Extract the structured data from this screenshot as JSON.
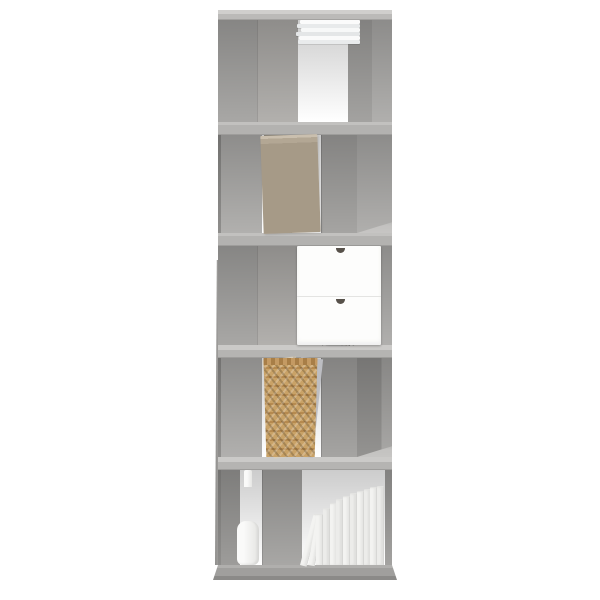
{
  "meta": {
    "kind": "product-photograph",
    "background_color": "#ffffff"
  },
  "product": {
    "name": "5-tier book cabinet room divider, concrete grey",
    "style": "staggered open cubes with alternating vertical dividers, open back",
    "tier_count": 5,
    "frame_color_name": "concrete grey",
    "palette": {
      "frame_light": "#c9c8c6",
      "frame_mid": "#aeadab",
      "frame_dark": "#8f8e8c",
      "background": "#ffffff"
    }
  },
  "decor": {
    "tier1": {
      "item": "stack of white magazines lying flat",
      "layers": 6,
      "color": "#f6f7f7"
    },
    "tier2": {
      "items": [
        "wooden picture frame",
        "wooden block",
        "stack of wooden planks"
      ],
      "colors": [
        "#8f897d",
        "#c59a67",
        "#b3a794"
      ]
    },
    "tier3": {
      "items": [
        "white pen cup with pens, pencils and brushes",
        "white mini drawer unit"
      ],
      "pen_count": 9,
      "drawer_count": 2,
      "colors": [
        "#f4f4f2",
        "#fdfdfc"
      ]
    },
    "tier4": {
      "items": [
        "woven wicker basket",
        "paper folders sticking out"
      ],
      "colors": [
        "#c49a63",
        "#d6cdbd",
        "#bcbdc2"
      ]
    },
    "tier5": {
      "items": [
        "white bottle vase",
        "row of white books"
      ],
      "book_count": 12,
      "colors": [
        "#f3f3f1",
        "#f0f0ee"
      ]
    }
  },
  "render": {
    "magazine_layers": [
      {
        "c": "#fbfbfb",
        "off": 4
      },
      {
        "c": "#e8eaeb",
        "off": 1
      },
      {
        "c": "#f7f8f8",
        "off": 5
      },
      {
        "c": "#e4e6e7",
        "off": 0
      },
      {
        "c": "#fafafa",
        "off": 3
      },
      {
        "c": "#e9ebec",
        "off": 2
      }
    ],
    "pens": [
      {
        "x": 4,
        "h": 26,
        "a": -30,
        "c": "#2f2f2f"
      },
      {
        "x": 8,
        "h": 30,
        "a": -14,
        "c": "#777777"
      },
      {
        "x": 12,
        "h": 24,
        "a": -6,
        "c": "#8a6a4a"
      },
      {
        "x": 15,
        "h": 31,
        "a": 0,
        "c": "#3c3c3c"
      },
      {
        "x": 19,
        "h": 27,
        "a": 4,
        "c": "#9b9b9b"
      },
      {
        "x": 22,
        "h": 30,
        "a": 10,
        "c": "#2f2f2f"
      },
      {
        "x": 26,
        "h": 24,
        "a": 18,
        "c": "#6e5a43"
      },
      {
        "x": 29,
        "h": 28,
        "a": 26,
        "c": "#444444"
      },
      {
        "x": 33,
        "h": 22,
        "a": 34,
        "c": "#8c8c8c"
      }
    ],
    "books": {
      "leaning": [
        {
          "h": 52,
          "a": 15
        },
        {
          "h": 50,
          "a": 10
        }
      ],
      "upright": [
        50,
        56,
        61,
        65,
        68,
        71,
        73,
        75,
        77,
        78
      ]
    }
  }
}
